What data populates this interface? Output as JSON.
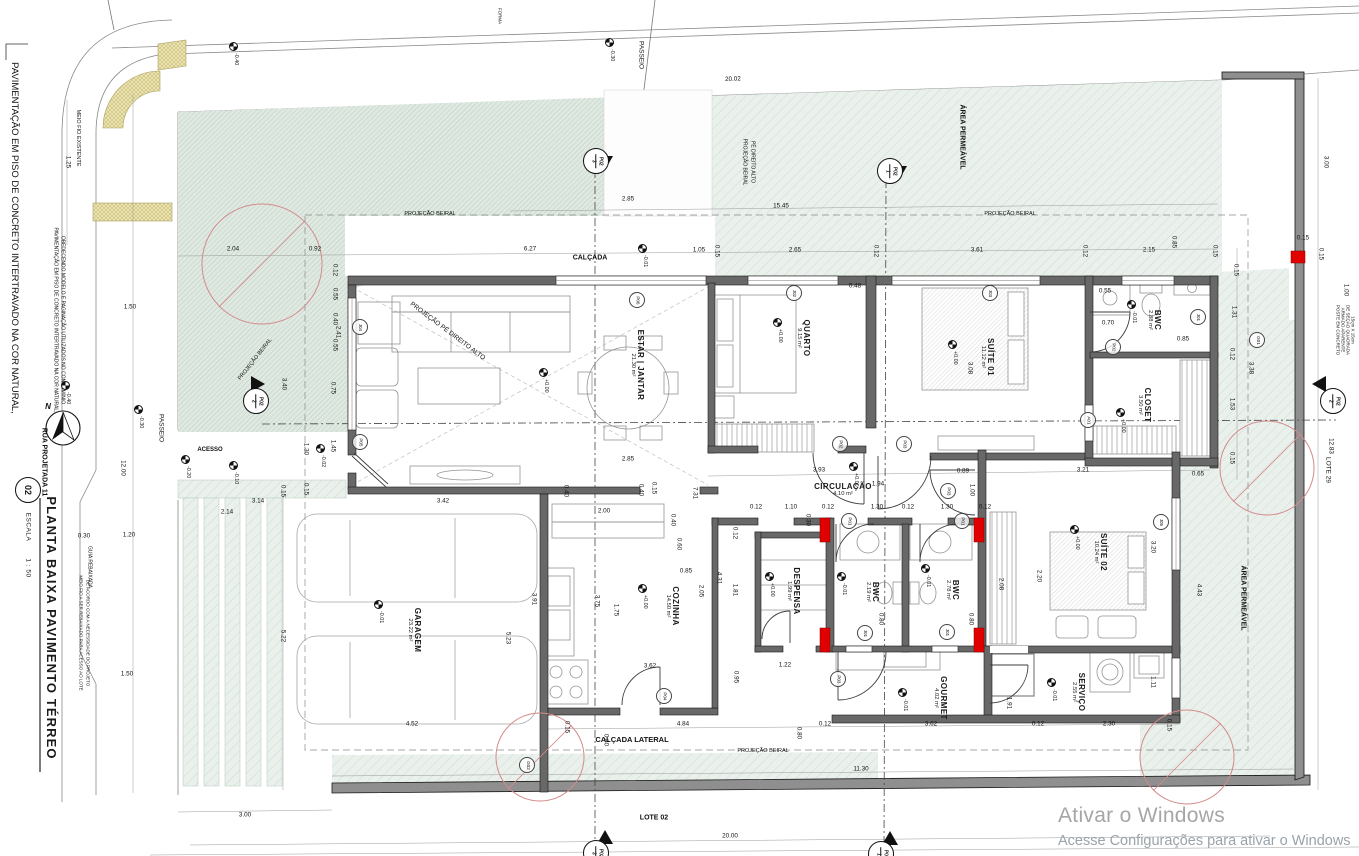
{
  "title_block": {
    "number": "02",
    "title": "PLANTA BAIXA PAVIMENTO TÉRREO",
    "scale_label": "ESCALA",
    "scale_value": "1 : 50"
  },
  "watermark": {
    "line1": "Ativar o Windows",
    "line2": "Acesse Configurações para ativar o Windows"
  },
  "colors": {
    "green_area": "#eaf1ec",
    "green_dense": "#dfe9e2",
    "hatch": "#c6d8cc",
    "yellow_curb": "#ece4ac",
    "wall": "#686868",
    "muro": "#8f8f8f",
    "red_accent": "#e00000",
    "tree": "#d48a8a",
    "watermark_gray": "#a6a6a6"
  },
  "rooms": [
    {
      "name": "ESTAR | JANTAR",
      "area": "21.30 m²",
      "x": 637,
      "y": 365,
      "r": 90
    },
    {
      "name": "QUARTO",
      "area": "9.15 m²",
      "x": 803,
      "y": 338,
      "r": 90
    },
    {
      "name": "SUÍTE 01",
      "area": "11.12 m²",
      "x": 987,
      "y": 357,
      "r": 90
    },
    {
      "name": "BWC",
      "area": "2.88 m²",
      "x": 1154,
      "y": 320,
      "r": 90
    },
    {
      "name": "CLOSET",
      "area": "3.50 m²",
      "x": 1144,
      "y": 405,
      "r": 90
    },
    {
      "name": "CIRCULAÇÃO",
      "area": "4.10 m²",
      "x": 843,
      "y": 490,
      "r": 0
    },
    {
      "name": "DESPENSA",
      "area": "1.99 m²",
      "x": 793,
      "y": 591,
      "r": 90
    },
    {
      "name": "COZINHA",
      "area": "14.50 m²",
      "x": 672,
      "y": 606,
      "r": 90
    },
    {
      "name": "BWC",
      "area": "2.19 m²",
      "x": 872,
      "y": 592,
      "r": 90
    },
    {
      "name": "BWC",
      "area": "2.78 m²",
      "x": 952,
      "y": 590,
      "r": 90
    },
    {
      "name": "SUÍTE 02",
      "area": "10.24 m²",
      "x": 1100,
      "y": 552,
      "r": 90
    },
    {
      "name": "GARAGEM",
      "area": "23.22 m²",
      "x": 414,
      "y": 630,
      "r": 90
    },
    {
      "name": "GOURMET",
      "area": "4.02 m²",
      "x": 940,
      "y": 698,
      "r": 90
    },
    {
      "name": "SERVIÇO",
      "area": "2.55 m²",
      "x": 1078,
      "y": 692,
      "r": 90
    }
  ],
  "dims": [
    {
      "t": "20.02",
      "x": 733,
      "y": 80,
      "r": -2
    },
    {
      "t": "2.85",
      "x": 628,
      "y": 200
    },
    {
      "t": "15.45",
      "x": 781,
      "y": 207
    },
    {
      "t": "2.04",
      "x": 233,
      "y": 250
    },
    {
      "t": "0.92",
      "x": 315,
      "y": 250
    },
    {
      "t": "6.27",
      "x": 530,
      "y": 250
    },
    {
      "t": "1.05",
      "x": 699,
      "y": 251
    },
    {
      "t": "0.15",
      "x": 716,
      "y": 251,
      "r": 90
    },
    {
      "t": "2.65",
      "x": 795,
      "y": 251
    },
    {
      "t": "0.12",
      "x": 875,
      "y": 251,
      "r": 90
    },
    {
      "t": "0.48",
      "x": 855,
      "y": 287
    },
    {
      "t": "3.61",
      "x": 977,
      "y": 251
    },
    {
      "t": "0.12",
      "x": 1084,
      "y": 251,
      "r": 90
    },
    {
      "t": "2.15",
      "x": 1149,
      "y": 251
    },
    {
      "t": "0.85",
      "x": 1173,
      "y": 242,
      "r": 90
    },
    {
      "t": "0.15",
      "x": 1214,
      "y": 251,
      "r": 90
    },
    {
      "t": "0.15",
      "x": 1303,
      "y": 239
    },
    {
      "t": "3.00",
      "x": 1325,
      "y": 162,
      "r": 90
    },
    {
      "t": "0.15",
      "x": 1320,
      "y": 254,
      "r": 90
    },
    {
      "t": "1.00",
      "x": 1345,
      "y": 290,
      "r": 90
    },
    {
      "t": "0.15",
      "x": 1235,
      "y": 270,
      "r": 90
    },
    {
      "t": "1.31",
      "x": 1233,
      "y": 312,
      "r": 90
    },
    {
      "t": "0.12",
      "x": 1231,
      "y": 354,
      "r": 90
    },
    {
      "t": "3.38",
      "x": 1250,
      "y": 368,
      "r": 90
    },
    {
      "t": "1.53",
      "x": 1231,
      "y": 404,
      "r": 90
    },
    {
      "t": "0.15",
      "x": 1231,
      "y": 458,
      "r": 90
    },
    {
      "t": "12.83",
      "x": 1330,
      "y": 446,
      "r": 90
    },
    {
      "t": "1.25",
      "x": 67,
      "y": 162,
      "r": 90
    },
    {
      "t": "1.50",
      "x": 130,
      "y": 308
    },
    {
      "t": "12.00",
      "x": 122,
      "y": 468,
      "r": 90
    },
    {
      "t": "0.30",
      "x": 84,
      "y": 537
    },
    {
      "t": "1.20",
      "x": 129,
      "y": 536
    },
    {
      "t": "1.50",
      "x": 127,
      "y": 675
    },
    {
      "t": "3.00",
      "x": 245,
      "y": 816
    },
    {
      "t": "5.22",
      "x": 282,
      "y": 636,
      "r": 90
    },
    {
      "t": "2.14",
      "x": 227,
      "y": 513
    },
    {
      "t": "3.14",
      "x": 258,
      "y": 502
    },
    {
      "t": "0.15",
      "x": 282,
      "y": 491,
      "r": 90
    },
    {
      "t": "0.15",
      "x": 305,
      "y": 489,
      "r": 90
    },
    {
      "t": "1.30",
      "x": 305,
      "y": 449,
      "r": 90
    },
    {
      "t": "1.45",
      "x": 332,
      "y": 446,
      "r": 90
    },
    {
      "t": "0.75",
      "x": 332,
      "y": 388,
      "r": 90
    },
    {
      "t": "3.40",
      "x": 283,
      "y": 384,
      "r": 90
    },
    {
      "t": "2.41",
      "x": 337,
      "y": 332,
      "r": 90
    },
    {
      "t": "0.12",
      "x": 334,
      "y": 270,
      "r": 90
    },
    {
      "t": "0.55",
      "x": 334,
      "y": 294,
      "r": 90
    },
    {
      "t": "0.40",
      "x": 334,
      "y": 319,
      "r": 90
    },
    {
      "t": "0.55",
      "x": 334,
      "y": 345,
      "r": 90
    },
    {
      "t": "2.85",
      "x": 628,
      "y": 460
    },
    {
      "t": "0.40",
      "x": 640,
      "y": 490,
      "r": 90
    },
    {
      "t": "0.15",
      "x": 653,
      "y": 488,
      "r": 90
    },
    {
      "t": "7.31",
      "x": 694,
      "y": 493,
      "r": 90
    },
    {
      "t": "2.00",
      "x": 604,
      "y": 512
    },
    {
      "t": "0.40",
      "x": 672,
      "y": 520,
      "r": 90
    },
    {
      "t": "0.60",
      "x": 678,
      "y": 544,
      "r": 90
    },
    {
      "t": "0.85",
      "x": 686,
      "y": 572
    },
    {
      "t": "3.75",
      "x": 596,
      "y": 601,
      "r": 90
    },
    {
      "t": "1.75",
      "x": 615,
      "y": 610,
      "r": 90
    },
    {
      "t": "3.62",
      "x": 650,
      "y": 667
    },
    {
      "t": "0.95",
      "x": 735,
      "y": 677,
      "r": 90
    },
    {
      "t": "4.84",
      "x": 683,
      "y": 725
    },
    {
      "t": "3.42",
      "x": 443,
      "y": 502
    },
    {
      "t": "0.40",
      "x": 565,
      "y": 491,
      "r": 90
    },
    {
      "t": "3.91",
      "x": 533,
      "y": 599,
      "r": 90
    },
    {
      "t": "5.23",
      "x": 507,
      "y": 638,
      "r": 90
    },
    {
      "t": "4.52",
      "x": 412,
      "y": 725
    },
    {
      "t": "0.15",
      "x": 566,
      "y": 727,
      "r": 90
    },
    {
      "t": "3.93",
      "x": 819,
      "y": 471
    },
    {
      "t": "1.94",
      "x": 878,
      "y": 485
    },
    {
      "t": "0.89",
      "x": 963,
      "y": 472
    },
    {
      "t": "1.00",
      "x": 971,
      "y": 490,
      "r": 90
    },
    {
      "t": "3.21",
      "x": 1083,
      "y": 471
    },
    {
      "t": "0.65",
      "x": 1198,
      "y": 475
    },
    {
      "t": "0.12",
      "x": 756,
      "y": 508
    },
    {
      "t": "1.10",
      "x": 791,
      "y": 508
    },
    {
      "t": "0.12",
      "x": 828,
      "y": 508
    },
    {
      "t": "1.30",
      "x": 877,
      "y": 508
    },
    {
      "t": "0.12",
      "x": 908,
      "y": 508
    },
    {
      "t": "1.30",
      "x": 947,
      "y": 508
    },
    {
      "t": "0.12",
      "x": 985,
      "y": 508
    },
    {
      "t": "0.30",
      "x": 807,
      "y": 520,
      "r": 90
    },
    {
      "t": "0.12",
      "x": 734,
      "y": 533,
      "r": 90
    },
    {
      "t": "4.31",
      "x": 718,
      "y": 578,
      "r": 90
    },
    {
      "t": "1.81",
      "x": 734,
      "y": 590,
      "r": 90
    },
    {
      "t": "2.05",
      "x": 700,
      "y": 591,
      "r": 90
    },
    {
      "t": "0.80",
      "x": 880,
      "y": 619,
      "r": 90
    },
    {
      "t": "0.80",
      "x": 970,
      "y": 619,
      "r": 90
    },
    {
      "t": "2.08",
      "x": 1000,
      "y": 584,
      "r": 90
    },
    {
      "t": "1.22",
      "x": 785,
      "y": 666
    },
    {
      "t": "2.20",
      "x": 1038,
      "y": 576,
      "r": 90
    },
    {
      "t": "3.20",
      "x": 1152,
      "y": 547,
      "r": 90
    },
    {
      "t": "4.43",
      "x": 1198,
      "y": 590,
      "r": 90
    },
    {
      "t": "3.08",
      "x": 969,
      "y": 368,
      "r": 90
    },
    {
      "t": "0.55",
      "x": 1105,
      "y": 292
    },
    {
      "t": "0.70",
      "x": 1108,
      "y": 324
    },
    {
      "t": "0.85",
      "x": 1183,
      "y": 340
    },
    {
      "t": "3.62",
      "x": 931,
      "y": 725
    },
    {
      "t": "0.12",
      "x": 825,
      "y": 725
    },
    {
      "t": "0.12",
      "x": 1038,
      "y": 725
    },
    {
      "t": "2.30",
      "x": 1109,
      "y": 725
    },
    {
      "t": "0.15",
      "x": 1168,
      "y": 725,
      "r": 90
    },
    {
      "t": "0.80",
      "x": 798,
      "y": 733,
      "r": 90
    },
    {
      "t": "1.91",
      "x": 1008,
      "y": 703,
      "r": 90
    },
    {
      "t": "1.11",
      "x": 1152,
      "y": 682,
      "r": 90
    },
    {
      "t": "11.30",
      "x": 861,
      "y": 770
    },
    {
      "t": "20.00",
      "x": 730,
      "y": 837
    },
    {
      "t": "0.80",
      "x": 605,
      "y": 740,
      "r": 90
    }
  ],
  "labels": [
    {
      "t": "CALÇADA",
      "x": 590,
      "y": 258,
      "fs": 7,
      "b": 1
    },
    {
      "t": "CALÇADA LATERAL",
      "x": 632,
      "y": 740,
      "fs": 7.5,
      "b": 1
    },
    {
      "t": "PROJEÇÃO BEIRAL",
      "x": 430,
      "y": 215,
      "fs": 5.5
    },
    {
      "t": "PROJEÇÃO BEIRAL",
      "x": 1010,
      "y": 215,
      "fs": 5.5
    },
    {
      "t": "PROJEÇÃO BEIRAL",
      "x": 763,
      "y": 752,
      "fs": 5.5
    },
    {
      "t": "PROJEÇÃO BEIRAL",
      "x": 256,
      "y": 360,
      "r": -52,
      "fs": 5.5
    },
    {
      "t": "PROJEÇÃO BEIRAL",
      "x": 744,
      "y": 162,
      "r": 90,
      "fs": 5
    },
    {
      "t": "PÉ DIREITO ALTO",
      "x": 752,
      "y": 162,
      "r": 90,
      "fs": 5
    },
    {
      "t": "PROJEÇÃO PÉ DIREITO ALTO",
      "x": 447,
      "y": 332,
      "r": 37,
      "fs": 6.5
    },
    {
      "t": "ÁREA PERMEÁVEL",
      "x": 962,
      "y": 137,
      "r": 90,
      "fs": 7,
      "b": 1
    },
    {
      "t": "ÁREA PERMEÁVEL",
      "x": 1243,
      "y": 598,
      "r": 90,
      "fs": 7,
      "b": 1
    },
    {
      "t": "PASSEIO",
      "x": 640,
      "y": 55,
      "r": 90,
      "fs": 6.5
    },
    {
      "t": "PASSEIO",
      "x": 160,
      "y": 428,
      "r": 90,
      "fs": 6.5
    },
    {
      "t": "ACESSO",
      "x": 210,
      "y": 450,
      "fs": 6,
      "b": 1
    },
    {
      "t": "LOTE 02",
      "x": 654,
      "y": 818,
      "fs": 7,
      "b": 1
    },
    {
      "t": "LOTE 29",
      "x": 1327,
      "y": 470,
      "r": 90,
      "fs": 6.5
    },
    {
      "t": "RUA PROJETADA 11",
      "x": 44,
      "y": 462,
      "r": 90,
      "fs": 7,
      "b": 1
    },
    {
      "t": "MEIO FIO EXISTENTE",
      "x": 77,
      "y": 138,
      "r": 90,
      "fs": 5.5
    },
    {
      "t": "GUIA REBAIXADA",
      "x": 89,
      "y": 567,
      "r": 90,
      "fs": 5
    },
    {
      "t": "MEIO FIO A SER REBAIXADO PARA ACESSO AO LOTE",
      "x": 80,
      "y": 633,
      "r": 90,
      "fs": 4.5
    },
    {
      "t": "DE ACORDO COM A NECESSIDADE DO PROJETO",
      "x": 87,
      "y": 633,
      "r": 90,
      "fs": 4.5
    },
    {
      "t": "POSTE EM CONCRETO",
      "x": 1337,
      "y": 330,
      "r": 90,
      "fs": 4.5
    },
    {
      "t": "ARMADO APARENTE",
      "x": 1342,
      "y": 330,
      "r": 90,
      "fs": 4.5
    },
    {
      "t": "DE SEÇÃO QUADRADA",
      "x": 1347,
      "y": 330,
      "r": 90,
      "fs": 4.5
    },
    {
      "t": "15cm X 15cm",
      "x": 1352,
      "y": 330,
      "r": 90,
      "fs": 4.5
    },
    {
      "t": "PAVIMENTAÇÃO EM PISO DE CONCRETO INTERTRAVADO NA COR NATURAL,",
      "x": 14,
      "y": 238,
      "r": 90,
      "fs": 9.5
    },
    {
      "t": "PAVIMENTAÇÃO EM PISO DE CONCRETO INTERTRAVADO NA COR NATURAL,",
      "x": 55,
      "y": 320,
      "r": 90,
      "fs": 5
    },
    {
      "t": "OBEDECENDO MODELO E PAGINAÇÃO UTILIZADOS NO CONDOMÍNIO",
      "x": 62,
      "y": 320,
      "r": 90,
      "fs": 5
    },
    {
      "t": "N",
      "x": 48,
      "y": 407,
      "fs": 8,
      "b": 1,
      "i": 1
    },
    {
      "t": "FORMA",
      "x": 499,
      "y": 16,
      "r": 90,
      "fs": 4.5
    }
  ],
  "tags": [
    {
      "t": "P01",
      "x": 849,
      "y": 521
    },
    {
      "t": "P01",
      "x": 962,
      "y": 521
    },
    {
      "t": "P02",
      "x": 840,
      "y": 444
    },
    {
      "t": "P03",
      "x": 904,
      "y": 444
    },
    {
      "t": "P03",
      "x": 948,
      "y": 491
    },
    {
      "t": "P02",
      "x": 1113,
      "y": 347
    },
    {
      "t": "P03",
      "x": 838,
      "y": 679
    },
    {
      "t": "P04",
      "x": 664,
      "y": 696
    },
    {
      "t": "P05",
      "x": 360,
      "y": 442
    },
    {
      "t": "P06",
      "x": 637,
      "y": 300
    },
    {
      "t": "J01",
      "x": 1198,
      "y": 317
    },
    {
      "t": "J01",
      "x": 865,
      "y": 633
    },
    {
      "t": "J01",
      "x": 947,
      "y": 632
    },
    {
      "t": "J02",
      "x": 794,
      "y": 293
    },
    {
      "t": "J03",
      "x": 990,
      "y": 293
    },
    {
      "t": "J04",
      "x": 360,
      "y": 327
    },
    {
      "t": "J05",
      "x": 1161,
      "y": 522
    },
    {
      "t": "A01",
      "x": 1088,
      "y": 420
    },
    {
      "t": "G01",
      "x": 1257,
      "y": 340
    },
    {
      "t": "G02",
      "x": 527,
      "y": 765
    }
  ],
  "levels": [
    {
      "v": "+0.00",
      "x": 548,
      "y": 368
    },
    {
      "v": "+0.00",
      "x": 782,
      "y": 318
    },
    {
      "v": "+0.00",
      "x": 957,
      "y": 340
    },
    {
      "v": "-0.01",
      "x": 1136,
      "y": 300
    },
    {
      "v": "+0.00",
      "x": 1125,
      "y": 408
    },
    {
      "v": "+0.00",
      "x": 858,
      "y": 462
    },
    {
      "v": "+0.00",
      "x": 774,
      "y": 572
    },
    {
      "v": "-0.01",
      "x": 846,
      "y": 572
    },
    {
      "v": "-0.01",
      "x": 930,
      "y": 564
    },
    {
      "v": "+0.00",
      "x": 1079,
      "y": 525
    },
    {
      "v": "+0.00",
      "x": 647,
      "y": 584
    },
    {
      "v": "-0.01",
      "x": 383,
      "y": 600
    },
    {
      "v": "-0.01",
      "x": 907,
      "y": 688
    },
    {
      "v": "-0.01",
      "x": 1056,
      "y": 678
    },
    {
      "v": "-0.30",
      "x": 614,
      "y": 38
    },
    {
      "v": "-0.01",
      "x": 647,
      "y": 244
    },
    {
      "v": "-0.30",
      "x": 143,
      "y": 405
    },
    {
      "v": "-0.20",
      "x": 190,
      "y": 455
    },
    {
      "v": "-0.10",
      "x": 238,
      "y": 461
    },
    {
      "v": "-0.40",
      "x": 70,
      "y": 381
    },
    {
      "v": "-0.40",
      "x": 238,
      "y": 42
    },
    {
      "v": "-0.02",
      "x": 325,
      "y": 444
    }
  ],
  "sections": [
    {
      "l": "P02",
      "n": "3",
      "x": 595,
      "y": 160,
      "d": "down"
    },
    {
      "l": "P02",
      "n": "1",
      "x": 889,
      "y": 170,
      "d": "down"
    },
    {
      "l": "P02",
      "n": "2",
      "x": 255,
      "y": 400,
      "d": "right"
    },
    {
      "l": "P02",
      "n": "2",
      "x": 1332,
      "y": 400,
      "d": "left"
    },
    {
      "l": "P02",
      "n": "3",
      "x": 595,
      "y": 852,
      "d": "up"
    },
    {
      "l": "P02",
      "n": "1",
      "x": 880,
      "y": 853,
      "d": "up"
    }
  ],
  "trees": [
    {
      "x": 262,
      "y": 264,
      "radius": 60,
      "label": "ø 1.50"
    },
    {
      "x": 1267,
      "y": 468,
      "radius": 47,
      "label": "ø 1.50"
    },
    {
      "x": 1187,
      "y": 757,
      "radius": 47,
      "label": "ø 1.50"
    },
    {
      "x": 540,
      "y": 757,
      "radius": 44,
      "label": "ø 1.50"
    }
  ]
}
